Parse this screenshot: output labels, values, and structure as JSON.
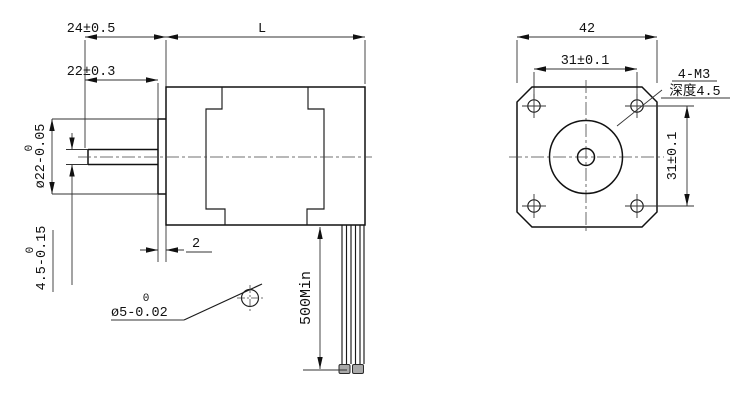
{
  "title": "stepper-motor-dimension-drawing",
  "side_view": {
    "dims": {
      "shaft_total": "24±0.5",
      "shaft_exposed": "22±0.3",
      "body_length": "L",
      "boss_dia": {
        "upper": "0",
        "main": "ø22-0.05"
      },
      "shaft_flat": {
        "upper": "0",
        "main": "4.5-0.15"
      },
      "boss_height": "2",
      "shaft_dia": {
        "upper": "0",
        "main": "ø5-0.02"
      },
      "wire_length": "500Min"
    }
  },
  "front_view": {
    "dims": {
      "body_width": "42",
      "hole_spacing_horizontal": "31±0.1",
      "hole_spacing_vertical": "31±0.1",
      "thread_spec": "4-M3",
      "thread_depth": "深度4.5"
    }
  }
}
